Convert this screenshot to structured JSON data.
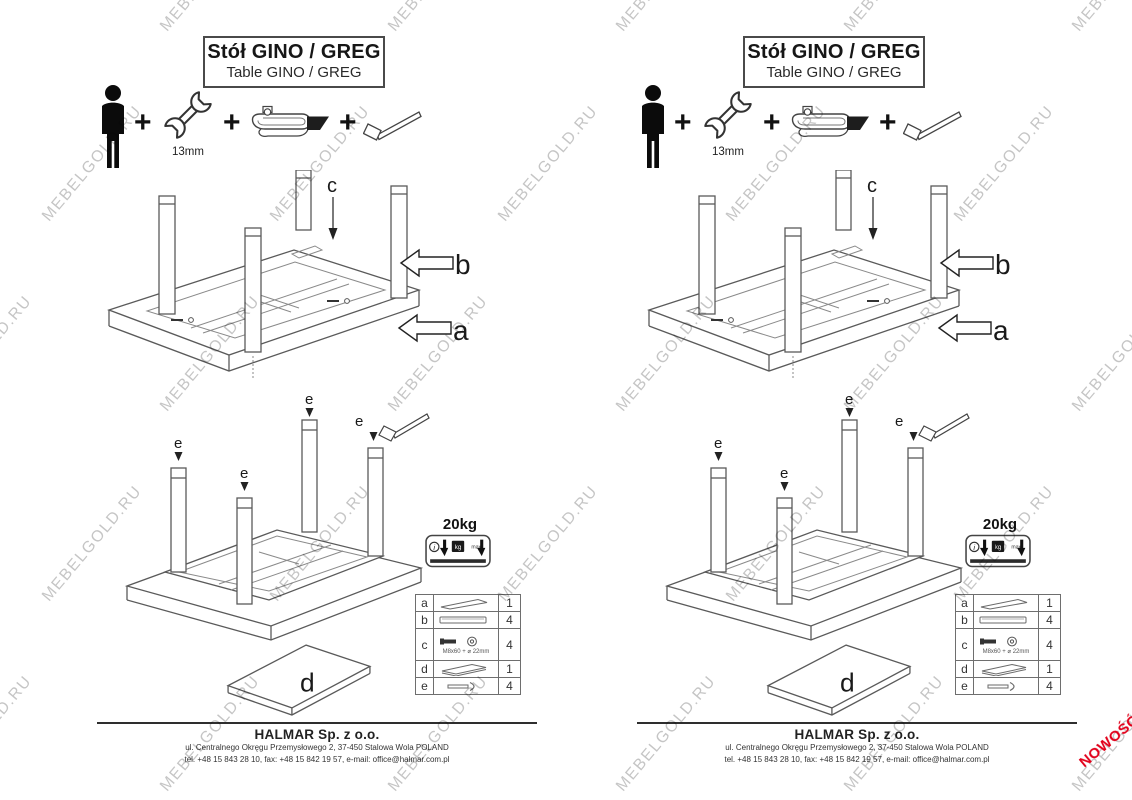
{
  "watermark": {
    "text": "MEBELGOLD.RU",
    "color": "rgba(150,150,150,0.55)"
  },
  "new_badge": {
    "text": "NOWOŚĆ",
    "color": "#e2001a"
  },
  "page": {
    "title": {
      "line1": "Stół GINO / GREG",
      "line2": "Table GINO / GREG"
    },
    "tools": {
      "plus": "+",
      "wrench_label": "13mm"
    },
    "diagram1": {
      "label_a": "a",
      "label_b": "b",
      "label_c": "c"
    },
    "diagram2": {
      "label_e": "e"
    },
    "weight": {
      "value": "20kg",
      "info": "i",
      "kg": "kg",
      "max": "max"
    },
    "parts": {
      "rows": [
        {
          "letter": "a",
          "qty": "1"
        },
        {
          "letter": "b",
          "qty": "4"
        },
        {
          "letter": "c",
          "qty": "4",
          "note": "M8x60 + ⌀ 22mm"
        },
        {
          "letter": "d",
          "qty": "1"
        },
        {
          "letter": "e",
          "qty": "4"
        }
      ]
    },
    "diagram_d": {
      "label": "d"
    },
    "footer": {
      "company": "HALMAR Sp. z o.o.",
      "address": "ul. Centralnego Okręgu Przemysłowego 2, 37-450 Stalowa Wola POLAND",
      "contact": "tel. +48 15 843 28 10, fax: +48 15 842 19 57, e-mail: office@halmar.com.pl"
    }
  }
}
